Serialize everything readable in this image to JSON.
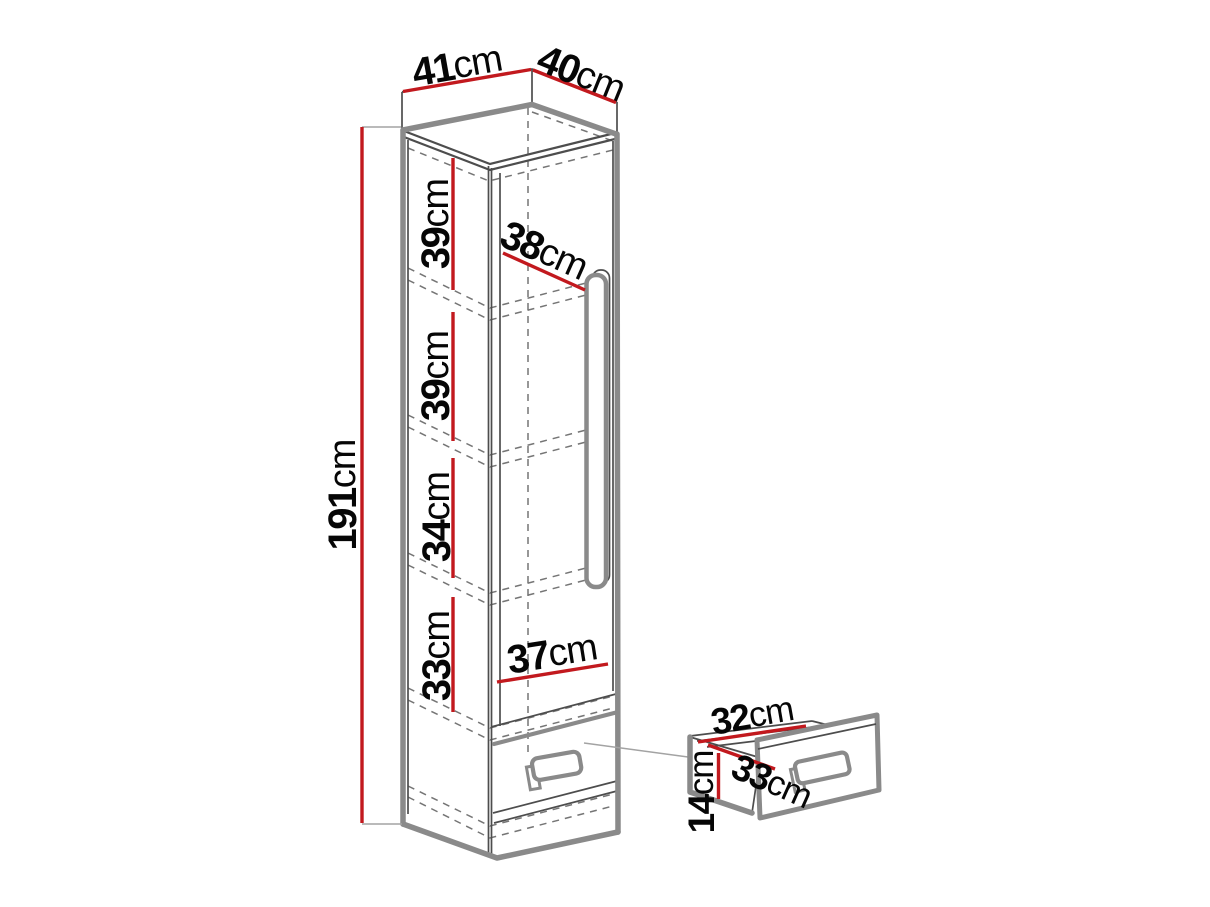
{
  "colors": {
    "dim-line": "#c2191e",
    "line-thick": "#8a8a8a",
    "line-thin": "#4d4d4d",
    "line-dashed": "#757575",
    "line-ext": "#a3a3a3",
    "label": "#060606"
  },
  "dimensions": {
    "top_width": {
      "value": "41",
      "unit": "cm"
    },
    "top_depth": {
      "value": "40",
      "unit": "cm"
    },
    "height": {
      "value": "191",
      "unit": "cm"
    },
    "interior_width": {
      "value": "38",
      "unit": "cm"
    },
    "bottom_interior_width": {
      "value": "37",
      "unit": "cm"
    },
    "shelf_gaps": [
      {
        "value": "39",
        "unit": "cm"
      },
      {
        "value": "39",
        "unit": "cm"
      },
      {
        "value": "34",
        "unit": "cm"
      },
      {
        "value": "33",
        "unit": "cm"
      }
    ]
  },
  "drawer_dimensions": {
    "width": {
      "value": "32",
      "unit": "cm"
    },
    "depth": {
      "value": "33",
      "unit": "cm"
    },
    "height": {
      "value": "14",
      "unit": "cm"
    }
  }
}
